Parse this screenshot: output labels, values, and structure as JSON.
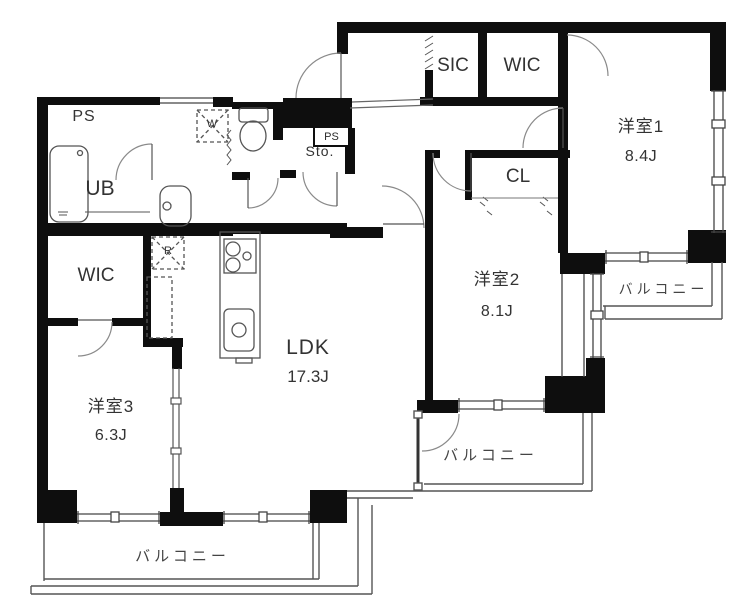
{
  "floorplan": {
    "unit_labels": {
      "ldk": {
        "name": "LDK",
        "size": "17.3J"
      },
      "bedroom1": {
        "name": "洋室1",
        "size": "8.4J"
      },
      "bedroom2": {
        "name": "洋室2",
        "size": "8.1J"
      },
      "bedroom3": {
        "name": "洋室3",
        "size": "6.3J"
      },
      "wic_main": "WIC",
      "wic_hall": "WIC",
      "sic": "SIC",
      "closet": "CL",
      "storage": "Sto.",
      "bath": "UB",
      "pipe_space": "PS",
      "pipe_space_small": "PS",
      "washer": "W",
      "refrigerator": "R",
      "balcony_south": "バルコニー",
      "balcony_center": "バルコニー",
      "balcony_east": "バルコニー"
    },
    "colors": {
      "wall": "#0e0e0e",
      "line": "#555555",
      "arc": "#888888",
      "text": "#333333"
    }
  }
}
